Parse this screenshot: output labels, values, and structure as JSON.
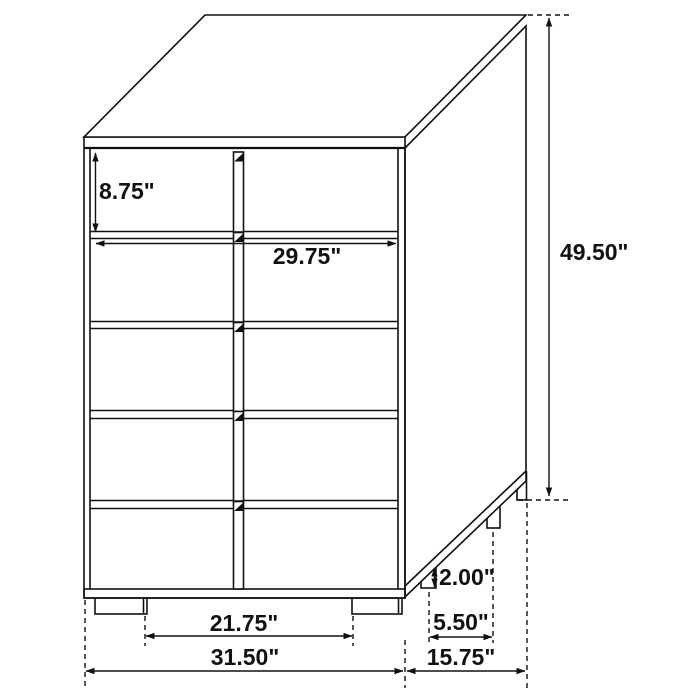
{
  "diagram": {
    "description": "5-drawer chest dimension drawing",
    "unit": "inches",
    "colors": {
      "line": "#111111",
      "background": "#ffffff"
    },
    "labels": {
      "drawer_height": "8.75\"",
      "opening_width": "29.75\"",
      "overall_height": "49.50\"",
      "leg_height": "2.00\"",
      "side_leg_spacing": "5.50\"",
      "front_leg_spacing": "21.75\"",
      "overall_width": "31.50\"",
      "overall_depth": "15.75\""
    }
  }
}
